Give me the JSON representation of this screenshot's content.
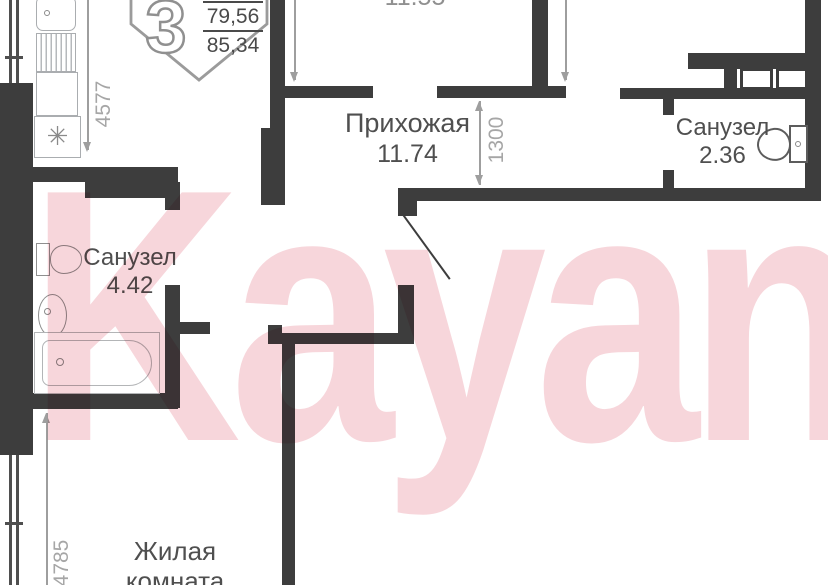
{
  "badge": {
    "rooms_count": "3",
    "area_upper": "79,56",
    "area_lower": "85,34"
  },
  "watermark": {
    "text": "Kayan"
  },
  "rooms": {
    "top": {
      "area": "11.55"
    },
    "hallway": {
      "name": "Прихожая",
      "area": "11.74"
    },
    "bath_small": {
      "name": "Санузел",
      "area": "2.36"
    },
    "bath_large": {
      "name": "Санузел",
      "area": "4.42"
    },
    "living": {
      "name_line1": "Жилая",
      "name_line2": "комната"
    }
  },
  "dimensions": {
    "top_left": "4577",
    "hallway": "1300",
    "bottom_left": "4785"
  },
  "symbols": {
    "stove": "✳"
  }
}
